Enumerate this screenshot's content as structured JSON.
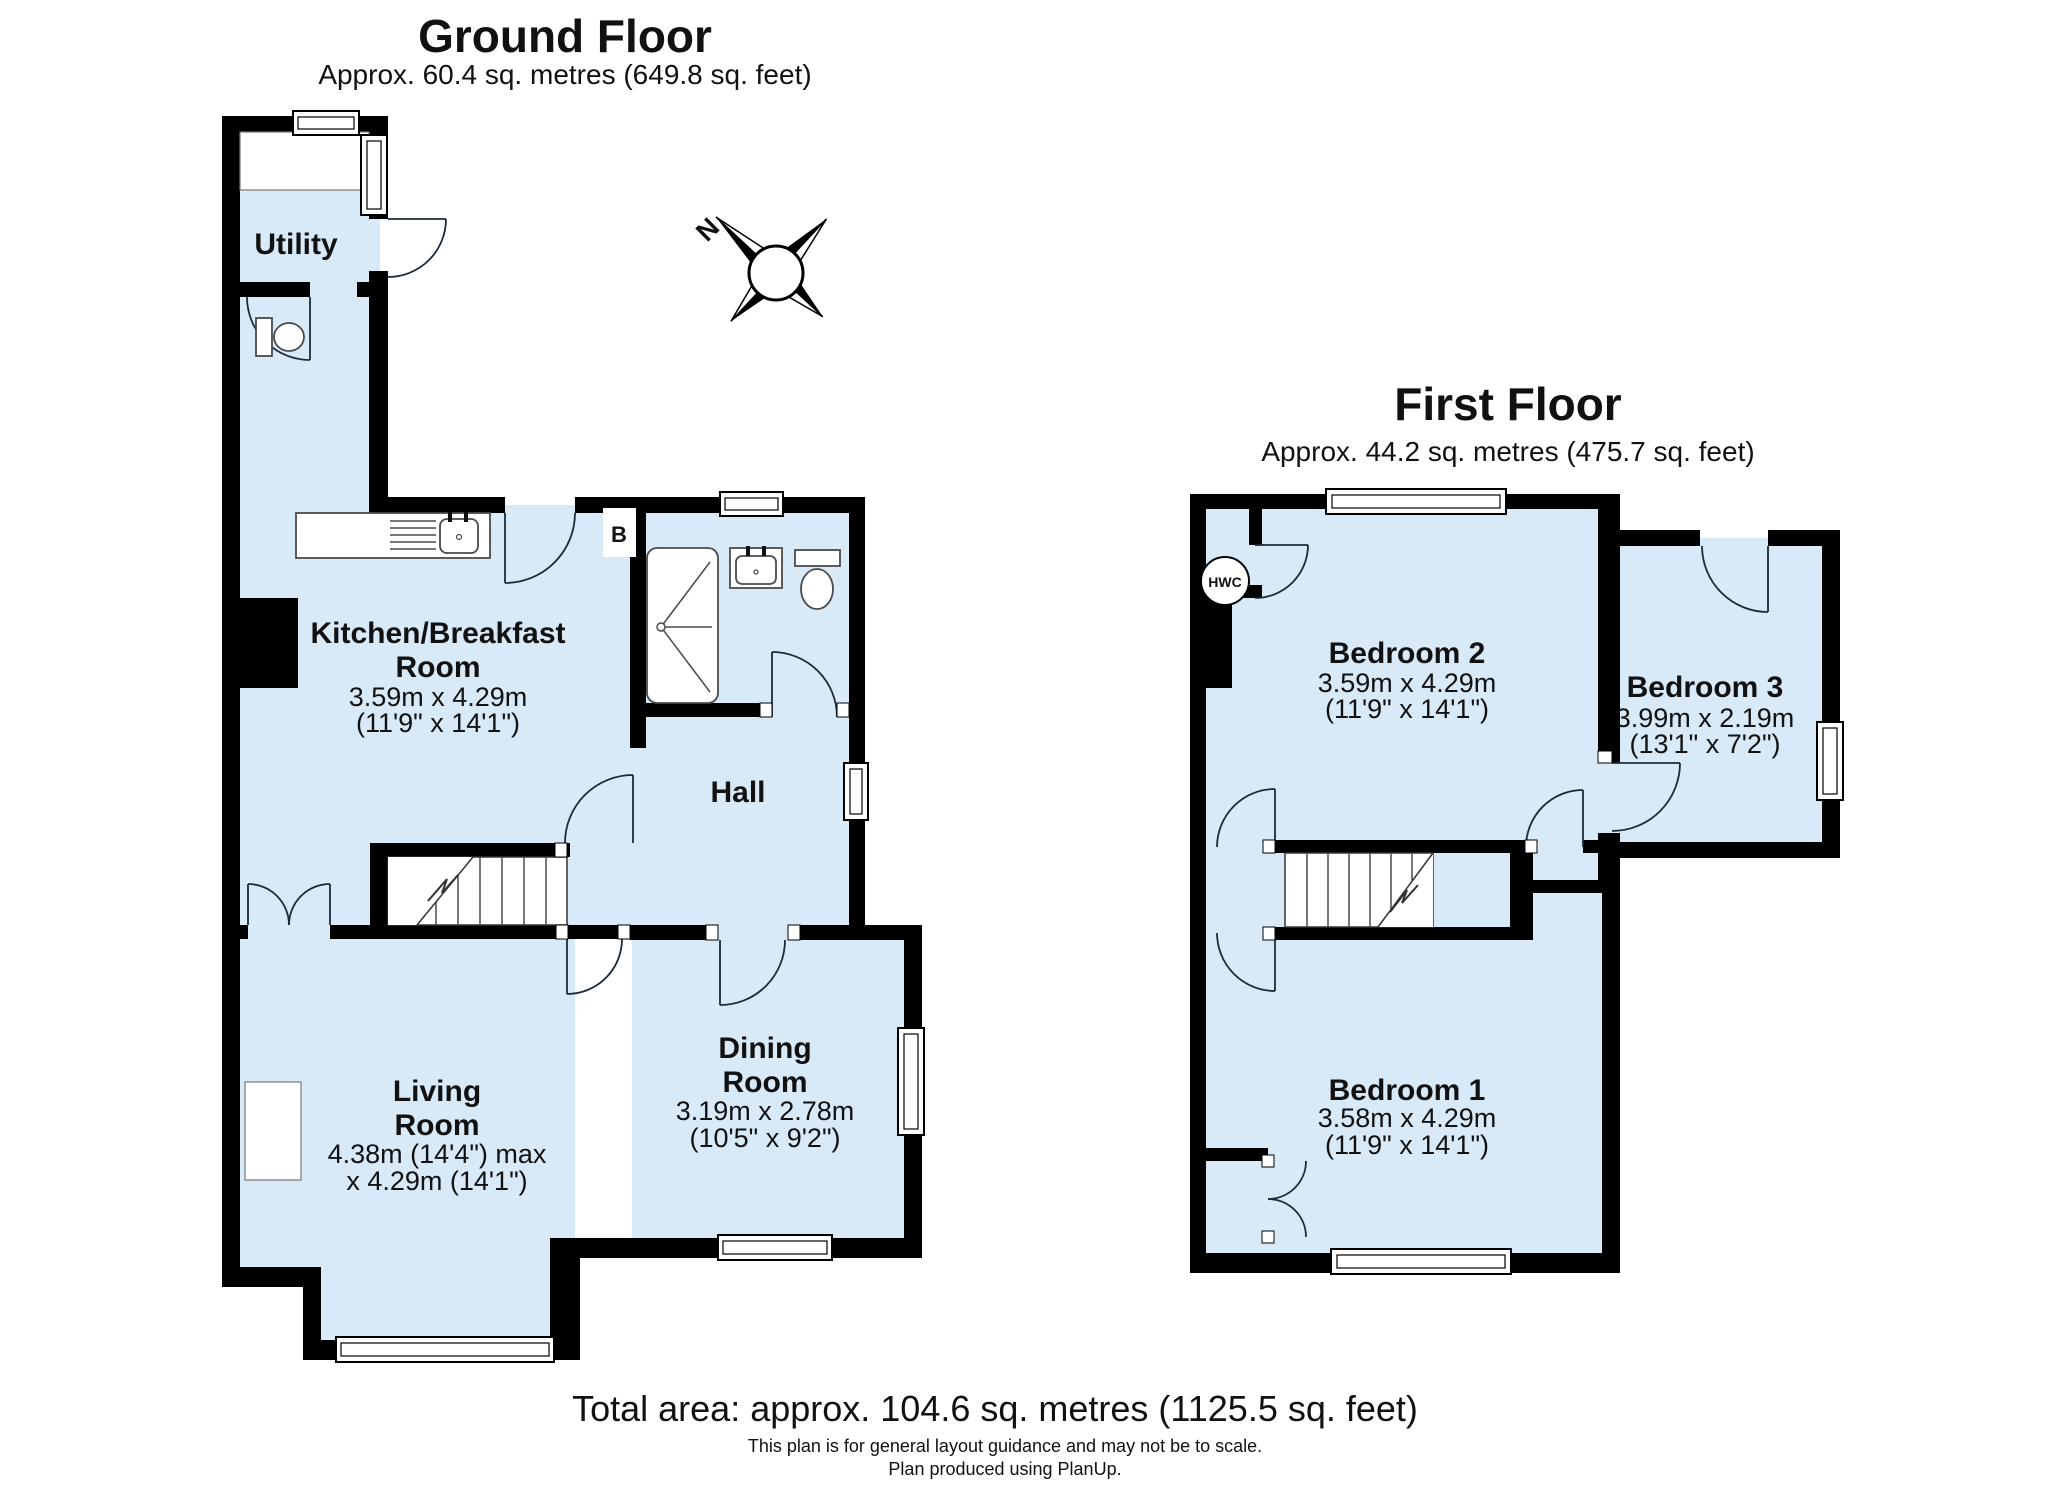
{
  "ground": {
    "title": "Ground Floor",
    "area": "Approx. 60.4 sq. metres (649.8 sq. feet)",
    "rooms": {
      "utility": {
        "name": "Utility"
      },
      "kitchen": {
        "name1": "Kitchen/Breakfast",
        "name2": "Room",
        "dims1": "3.59m x 4.29m",
        "dims2": "(11'9\" x 14'1\")"
      },
      "hall": {
        "name": "Hall"
      },
      "living": {
        "name1": "Living",
        "name2": "Room",
        "dims1": "4.38m (14'4\") max",
        "dims2": "x 4.29m (14'1\")"
      },
      "dining": {
        "name1": "Dining",
        "name2": "Room",
        "dims1": "3.19m x 2.78m",
        "dims2": "(10'5\" x 9'2\")"
      }
    },
    "markers": {
      "boiler": "B"
    }
  },
  "first": {
    "title": "First Floor",
    "area": "Approx. 44.2 sq. metres (475.7 sq. feet)",
    "rooms": {
      "bedroom1": {
        "name": "Bedroom 1",
        "dims1": "3.58m x 4.29m",
        "dims2": "(11'9\" x 14'1\")"
      },
      "bedroom2": {
        "name": "Bedroom 2",
        "dims1": "3.59m x 4.29m",
        "dims2": "(11'9\" x 14'1\")"
      },
      "bedroom3": {
        "name": "Bedroom 3",
        "dims1": "3.99m x 2.19m",
        "dims2": "(13'1\" x 7'2\")"
      }
    },
    "markers": {
      "hwc": "HWC"
    }
  },
  "compass": {
    "north": "N"
  },
  "footer": {
    "total": "Total area: approx. 104.6 sq. metres (1125.5 sq. feet)",
    "line1": "This plan is for general layout guidance and may not be to scale.",
    "line2": "Plan produced using PlanUp."
  },
  "colors": {
    "room_fill": "#d8e9f8",
    "wall": "#000000"
  }
}
